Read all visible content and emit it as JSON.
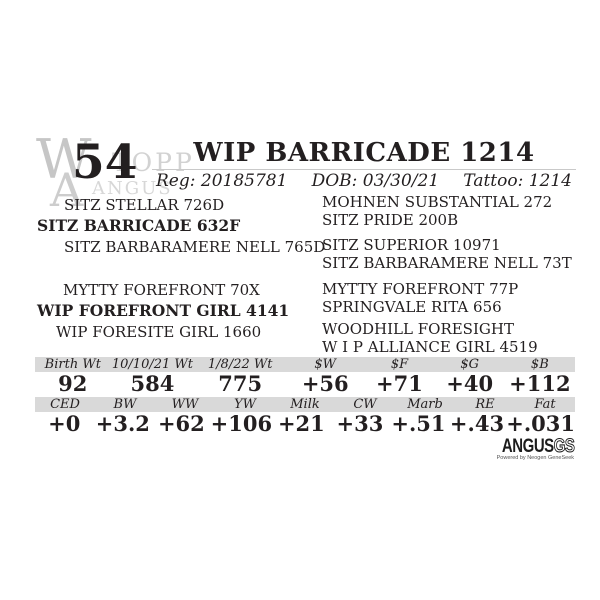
{
  "lot": {
    "number": "54"
  },
  "watermark": {
    "monogram_w": "W",
    "monogram_a": "A",
    "ranch": "TOPP",
    "breed": "ANGUS"
  },
  "header": {
    "animal_name": "WIP BARRICADE 1214",
    "reg_label": "Reg:",
    "reg_value": "20185781",
    "dob_label": "DOB:",
    "dob_value": "03/30/21",
    "tattoo_label": "Tattoo:",
    "tattoo_value": "1214"
  },
  "pedigree": {
    "sire_line": {
      "grandsire": "SITZ STELLAR 726D",
      "sire": "SITZ BARRICADE 632F",
      "granddam": "SITZ BARBARAMERE NELL 765D"
    },
    "dam_line": {
      "grandsire": "MYTTY FOREFRONT 70X",
      "dam": "WIP FOREFRONT GIRL 4141",
      "granddam": "WIP FORESITE GIRL 1660"
    },
    "ancestors": [
      "MOHNEN SUBSTANTIAL 272",
      "SITZ PRIDE 200B",
      "SITZ SUPERIOR 10971",
      "SITZ BARBARAMERE NELL 73T",
      "MYTTY FOREFRONT 77P",
      "SPRINGVALE RITA 656",
      "WOODHILL FORESIGHT",
      "W I P ALLIANCE GIRL 4519"
    ]
  },
  "weights_table": {
    "headers": [
      "Birth Wt",
      "10/10/21 Wt",
      "1/8/22 Wt",
      "$W",
      "$F",
      "$G",
      "$B"
    ],
    "values": [
      "92",
      "584",
      "775",
      "+56",
      "+71",
      "+40",
      "+112"
    ]
  },
  "epd_table": {
    "headers": [
      "CED",
      "BW",
      "WW",
      "YW",
      "Milk",
      "CW",
      "Marb",
      "RE",
      "Fat"
    ],
    "values": [
      "+0",
      "+3.2",
      "+62",
      "+106",
      "+21",
      "+33",
      "+.51",
      "+.43",
      "+.031"
    ]
  },
  "logo": {
    "angus": "ANGUS",
    "gs": "GS",
    "tagline": "Powered by Neogen GeneSeek"
  },
  "colors": {
    "text": "#231f20",
    "band": "#d9d9d9",
    "watermark": "#c6c6c6",
    "rule": "#c9c9c9"
  }
}
